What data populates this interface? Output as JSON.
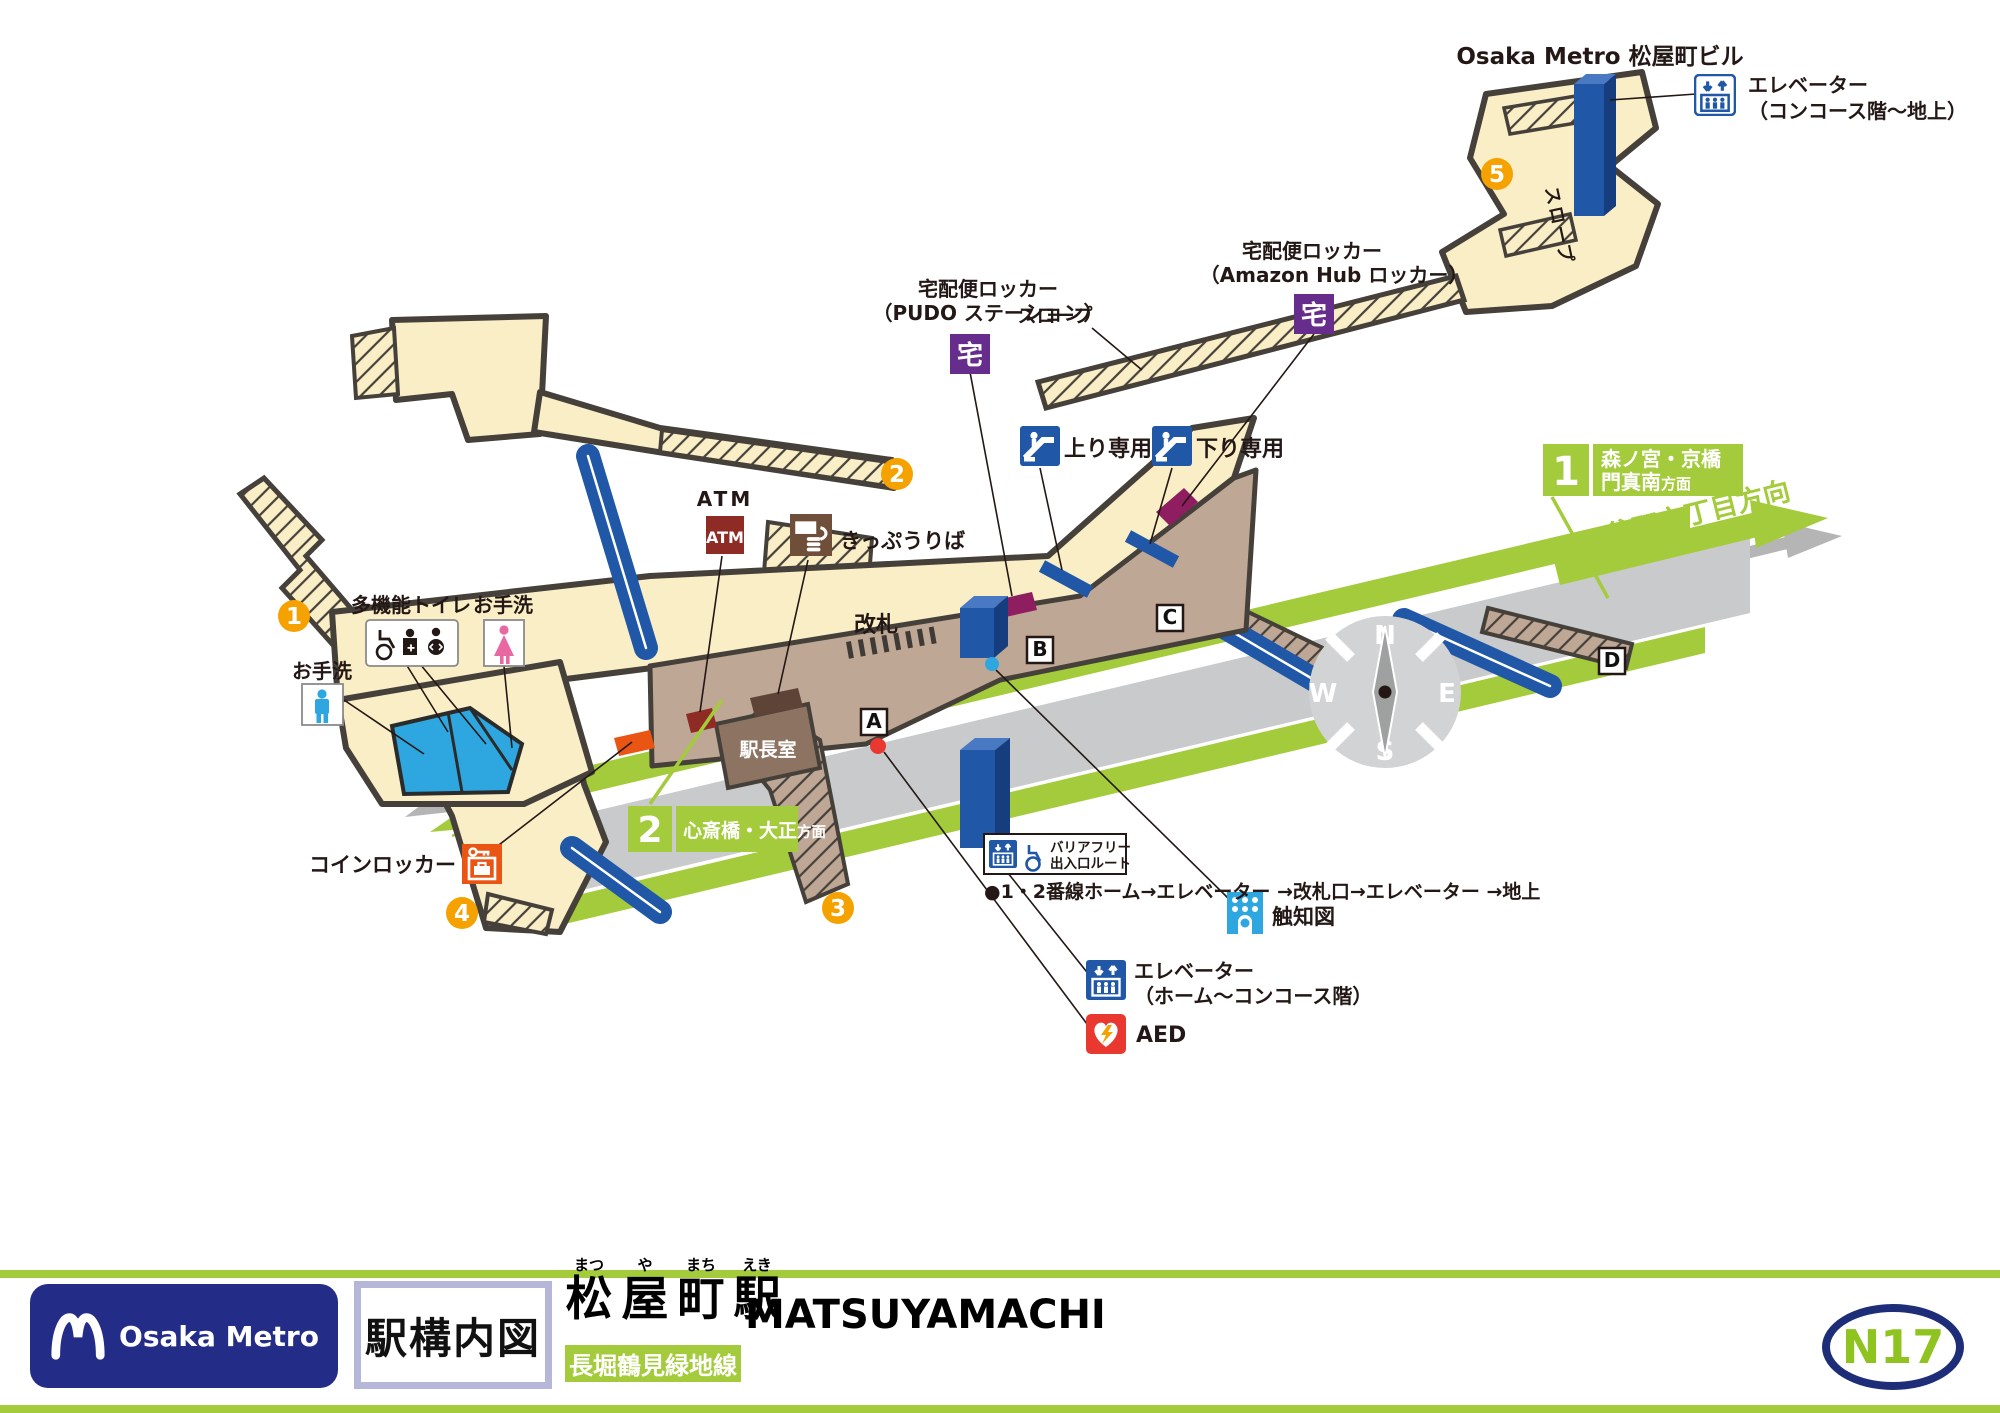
{
  "colors": {
    "line_green": "#a4cb3c",
    "metro_navy": "#232d88",
    "blue": "#2057a7",
    "cream": "#faeec6",
    "tan": "#bfa795",
    "purple": "#662d8d",
    "badge_orange": "#f5a200",
    "aed_red": "#e8382f",
    "atm_red": "#8e2b25",
    "locker_orange": "#ea5514",
    "locker_magenta": "#8e1e5f",
    "toilet_cyan": "#2ea7e0",
    "toilet_pink": "#ea68a2"
  },
  "map": {
    "building_label": "Osaka Metro 松屋町ビル",
    "concourse_elevator_note": {
      "line1": "エレベーター",
      "line2": "（コンコース階〜地上）"
    },
    "platform_elevator_note": {
      "line1": "エレベーター",
      "line2": "（ホーム〜コンコース階）"
    },
    "pudo_locker": {
      "line1": "宅配便ロッカー",
      "line2": "（PUDO ステーション）",
      "icon": "宅"
    },
    "amazon_locker": {
      "line1": "宅配便ロッカー",
      "line2": "（Amazon Hub ロッカー）",
      "icon": "宅"
    },
    "escalator_up": "上り専用",
    "escalator_down": "下り専用",
    "slope1": "スロープ",
    "slope2": "スロープ",
    "atm": {
      "label": "ATM",
      "icon": "ATM"
    },
    "ticket_window": "きっぷうりば",
    "gate": "改札",
    "office": "駅長室",
    "multi_toilet": "多機能トイレ",
    "toilet_f": "お手洗",
    "toilet_m": "お手洗",
    "coin_locker": "コインロッカー",
    "platform": "ホーム",
    "tactile": "触知図",
    "aed": "AED",
    "dir_tanimachi": "谷町六丁目方向",
    "dir_nagahoribashi": "長堀橋方向",
    "track1": {
      "num": "1",
      "dest": "森ノ宮・京橋",
      "dest2": "門真南",
      "suffix": "方面"
    },
    "track2": {
      "num": "2",
      "dest": "心斎橋・大正",
      "suffix": "方面"
    },
    "exits": {
      "e1": "1",
      "e2": "2",
      "e3": "3",
      "e4": "4",
      "e5": "5"
    },
    "letters": {
      "a": "A",
      "b": "B",
      "c": "C",
      "d": "D"
    },
    "compass": {
      "n": "N",
      "e": "E",
      "s": "S",
      "w": "W"
    },
    "barrier_free": {
      "line1": "バリアフリー",
      "line2": "出入口ルート"
    },
    "route": "●1・2番線ホーム→エレベーター →改札口→エレベーター →地上"
  },
  "footer": {
    "brand": "Osaka Metro",
    "doc_type": "駅構内図",
    "furigana": [
      "まつ",
      "や",
      "まち",
      "えき"
    ],
    "kanji": [
      "松",
      "屋",
      "町",
      "駅"
    ],
    "romaji": "MATSUYAMACHI",
    "line": "長堀鶴見緑地線",
    "number": "N17"
  }
}
